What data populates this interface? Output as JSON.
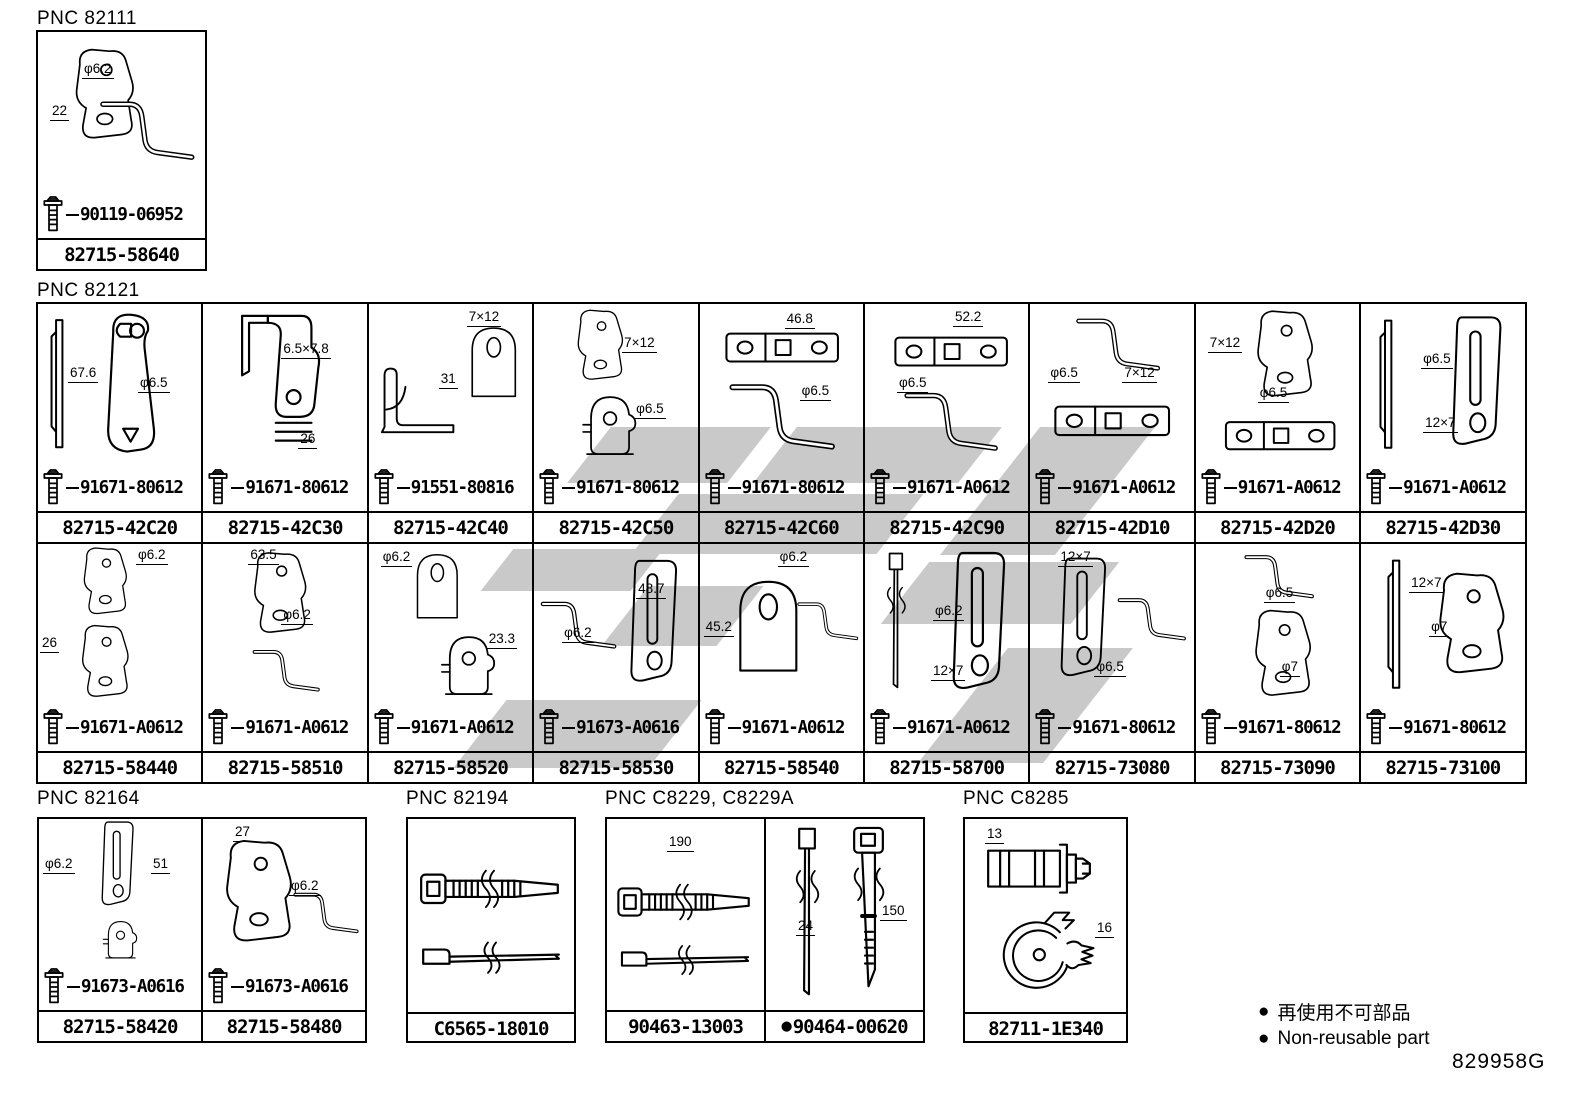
{
  "page": {
    "code": "829958G"
  },
  "legend": {
    "items": [
      {
        "bullet": "●",
        "text": "再使用不可部品"
      },
      {
        "bullet": "●",
        "text": "Non-reusable part"
      }
    ]
  },
  "sections": {
    "pnc82111": {
      "label": "PNC 82111",
      "cells": [
        {
          "dims": [
            "φ6.2",
            "22"
          ],
          "bolt": "90119-06952",
          "part": "82715-58640"
        }
      ]
    },
    "pnc82121": {
      "label": "PNC 82121",
      "cells": [
        {
          "dims": [
            "67.6",
            "φ6.5"
          ],
          "bolt": "91671-80612",
          "part": "82715-42C20"
        },
        {
          "dims": [
            "6.5×7.8",
            "26"
          ],
          "bolt": "91671-80612",
          "part": "82715-42C30"
        },
        {
          "dims": [
            "7×12",
            "31"
          ],
          "bolt": "91551-80816",
          "part": "82715-42C40"
        },
        {
          "dims": [
            "7×12",
            "φ6.5"
          ],
          "bolt": "91671-80612",
          "part": "82715-42C50"
        },
        {
          "dims": [
            "46.8",
            "φ6.5"
          ],
          "bolt": "91671-80612",
          "part": "82715-42C60"
        },
        {
          "dims": [
            "52.2",
            "φ6.5"
          ],
          "bolt": "91671-A0612",
          "part": "82715-42C90"
        },
        {
          "dims": [
            "φ6.5",
            "7×12"
          ],
          "bolt": "91671-A0612",
          "part": "82715-42D10"
        },
        {
          "dims": [
            "7×12",
            "φ6.5"
          ],
          "bolt": "91671-A0612",
          "part": "82715-42D20"
        },
        {
          "dims": [
            "φ6.5",
            "12×7"
          ],
          "bolt": "91671-A0612",
          "part": "82715-42D30"
        },
        {
          "dims": [
            "φ6.2",
            "26"
          ],
          "bolt": "91671-A0612",
          "part": "82715-58440"
        },
        {
          "dims": [
            "63.5",
            "φ6.2"
          ],
          "bolt": "91671-A0612",
          "part": "82715-58510"
        },
        {
          "dims": [
            "φ6.2",
            "23.3"
          ],
          "bolt": "91671-A0612",
          "part": "82715-58520"
        },
        {
          "dims": [
            "48.7",
            "φ6.2"
          ],
          "bolt": "91673-A0616",
          "part": "82715-58530"
        },
        {
          "dims": [
            "φ6.2",
            "45.2"
          ],
          "bolt": "91671-A0612",
          "part": "82715-58540"
        },
        {
          "dims": [
            "φ6.2",
            "12×7"
          ],
          "bolt": "91671-A0612",
          "part": "82715-58700"
        },
        {
          "dims": [
            "12×7",
            "φ6.5"
          ],
          "bolt": "91671-80612",
          "part": "82715-73080"
        },
        {
          "dims": [
            "φ6.5",
            "φ7"
          ],
          "bolt": "91671-80612",
          "part": "82715-73090"
        },
        {
          "dims": [
            "12×7",
            "φ7"
          ],
          "bolt": "91671-80612",
          "part": "82715-73100"
        }
      ]
    },
    "pnc82164": {
      "label": "PNC 82164",
      "cells": [
        {
          "dims": [
            "φ6.2",
            "51"
          ],
          "bolt": "91673-A0616",
          "part": "82715-58420"
        },
        {
          "dims": [
            "27",
            "φ6.2"
          ],
          "bolt": "91673-A0616",
          "part": "82715-58480"
        }
      ]
    },
    "pnc82194": {
      "label": "PNC 82194",
      "cells": [
        {
          "dims": [],
          "part": "C6565-18010"
        }
      ]
    },
    "pncC8229": {
      "label": "PNC C8229, C8229A",
      "cells": [
        {
          "dims": [
            "190"
          ],
          "part": "90463-13003"
        },
        {
          "dims": [
            "24",
            "150"
          ],
          "part": "90464-00620",
          "bullet": "●"
        }
      ]
    },
    "pncC8285": {
      "label": "PNC C8285",
      "cells": [
        {
          "dims": [
            "13",
            "16"
          ],
          "part": "82711-1E340"
        }
      ]
    }
  }
}
